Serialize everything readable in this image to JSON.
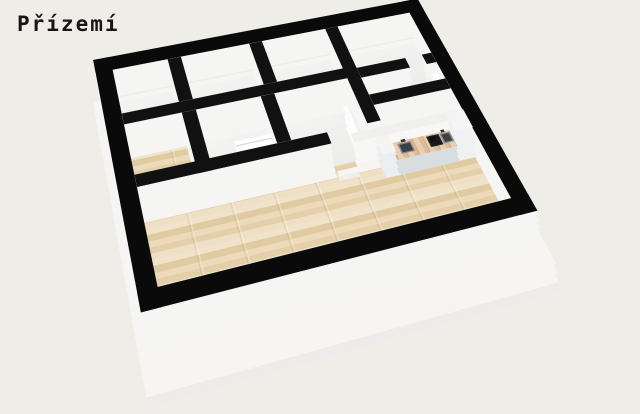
{
  "page": {
    "title": "Přízemí",
    "background": "#efede8",
    "title_color": "#161616"
  },
  "palette": {
    "wall_top": "#111111",
    "exterior_wall_top": "#0a0a0a",
    "wall_face": "#f5f5f4",
    "slab": "#f6f5f3",
    "slab_deep": "#edecea",
    "counter_front": "#d8dde0",
    "counter_top_wood": "#e6c39f",
    "halfwall_top": "#f1f0ee",
    "window_pane": "#ffffff",
    "wood_floor_base": "#e9d7b8"
  },
  "floorplan": {
    "plan_width": 460,
    "plan_height": 370,
    "matrix": [
      0.7873,
      -0.1336,
      0,
      0.0001967,
      0.0492,
      0.5056,
      0,
      -0.000566,
      -0.15,
      -1,
      1,
      0,
      98,
      92,
      0,
      1
    ],
    "wall_height": 32,
    "slab": {
      "u": -8,
      "v": 6,
      "w": 476,
      "h": 380,
      "depths": [
        -30,
        -22,
        -14,
        -6
      ]
    },
    "floors": [
      {
        "name": "room-top-left-floor",
        "u": 22,
        "v": 24,
        "w": 72,
        "h": 76,
        "surface": "plain"
      },
      {
        "name": "room-top-mid1-floor",
        "u": 112,
        "v": 24,
        "w": 93,
        "h": 76,
        "surface": "plain"
      },
      {
        "name": "room-top-mid2-floor",
        "u": 223,
        "v": 24,
        "w": 90,
        "h": 76,
        "surface": "plain"
      },
      {
        "name": "room-top-right-floor",
        "u": 331,
        "v": 24,
        "w": 107,
        "h": 80,
        "surface": "plain"
      },
      {
        "name": "room-mid-left-floor",
        "u": 112,
        "v": 118,
        "w": 84,
        "h": 78,
        "surface": "plain"
      },
      {
        "name": "room-mid-center-floor",
        "u": 214,
        "v": 118,
        "w": 99,
        "h": 78,
        "surface": "plain"
      },
      {
        "name": "room-right-a-floor",
        "u": 331,
        "v": 122,
        "w": 107,
        "h": 30,
        "surface": "plain"
      },
      {
        "name": "room-right-b-floor",
        "u": 331,
        "v": 170,
        "w": 107,
        "h": 26,
        "surface": "plain"
      },
      {
        "name": "hallway-wood-floor",
        "u": 22,
        "v": 118,
        "w": 72,
        "h": 78,
        "surface": "wood"
      },
      {
        "name": "doorway-threshold-floor",
        "u": 260,
        "v": 196,
        "w": 30,
        "h": 18,
        "surface": "wood"
      },
      {
        "name": "living-room-wood-floor",
        "u": 22,
        "v": 214,
        "w": 416,
        "h": 132,
        "surface": "wood"
      }
    ],
    "walls": [
      {
        "name": "exterior-wall-north",
        "u": 0,
        "v": 0,
        "w": 460,
        "h": 24,
        "height": 32,
        "exterior": true
      },
      {
        "name": "exterior-wall-south",
        "u": 0,
        "v": 346,
        "w": 460,
        "h": 24,
        "height": 32,
        "exterior": true
      },
      {
        "name": "exterior-wall-west",
        "u": 0,
        "v": 0,
        "w": 22,
        "h": 370,
        "height": 32,
        "exterior": true
      },
      {
        "name": "exterior-wall-east",
        "u": 438,
        "v": 0,
        "w": 22,
        "h": 370,
        "height": 32,
        "exterior": true
      },
      {
        "name": "wall-v1",
        "u": 94,
        "v": 24,
        "w": 18,
        "h": 76,
        "height": 32
      },
      {
        "name": "wall-v2",
        "u": 205,
        "v": 24,
        "w": 18,
        "h": 76,
        "height": 32
      },
      {
        "name": "wall-v3",
        "u": 313,
        "v": 24,
        "w": 18,
        "h": 172,
        "height": 32
      },
      {
        "name": "wall-h1",
        "u": 22,
        "v": 100,
        "w": 309,
        "h": 18,
        "height": 32
      },
      {
        "name": "wall-hall-right",
        "u": 94,
        "v": 118,
        "w": 18,
        "h": 96,
        "height": 32
      },
      {
        "name": "wall-mid-divider",
        "u": 196,
        "v": 118,
        "w": 18,
        "h": 78,
        "height": 32
      },
      {
        "name": "wall-living-north",
        "u": 22,
        "v": 196,
        "w": 238,
        "h": 18,
        "height": 32
      },
      {
        "name": "wall-h1b-west",
        "u": 331,
        "v": 104,
        "w": 69,
        "h": 18,
        "height": 32
      },
      {
        "name": "wall-h1b-east",
        "u": 424,
        "v": 104,
        "w": 14,
        "h": 18,
        "height": 32
      },
      {
        "name": "wall-h2b",
        "u": 331,
        "v": 152,
        "w": 107,
        "h": 18,
        "height": 32
      }
    ],
    "objects": [
      {
        "name": "kitchen-half-wall",
        "type": "stack",
        "u": 290,
        "v": 196,
        "w": 148,
        "h": 14,
        "height": 26,
        "top": "#f1f0ee",
        "face": "#f7f7f6"
      },
      {
        "name": "staircase",
        "type": "stack",
        "u": 150,
        "v": 150,
        "w": 46,
        "h": 46,
        "height": 14,
        "top": "treads",
        "face": "#fafaf9"
      },
      {
        "name": "door-leaf-hall",
        "type": "stack",
        "u": 294,
        "v": 152,
        "w": 6,
        "h": 44,
        "height": 26,
        "top": "#fdfdfd",
        "face": "#fdfdfc"
      },
      {
        "name": "door-leaf-room",
        "type": "stack",
        "u": 428,
        "v": 124,
        "w": 8,
        "h": 26,
        "height": 22,
        "top": "#fdfdfd",
        "face": "#fdfdfc"
      },
      {
        "name": "door-step",
        "type": "stack",
        "u": 262,
        "v": 214,
        "w": 26,
        "h": 8,
        "height": 6,
        "top": "#f6f6f5",
        "face": "#eeeeec"
      },
      {
        "name": "kitchen-tall-cabinet-left",
        "type": "stack",
        "u": 316,
        "v": 212,
        "w": 18,
        "h": 28,
        "height": 28,
        "top": "#f4f4f3",
        "face": "#eceff1"
      },
      {
        "name": "kitchen-counter",
        "type": "stack",
        "u": 334,
        "v": 214,
        "w": 80,
        "h": 26,
        "height": 20,
        "top": "wood2",
        "face": "#d8dde0"
      },
      {
        "name": "kitchen-tall-cabinet-right",
        "type": "stack",
        "u": 414,
        "v": 210,
        "w": 24,
        "h": 30,
        "height": 34,
        "top": "#f5f5f4",
        "face": "#eff1f2"
      },
      {
        "name": "window-pane-1",
        "type": "stack",
        "u": 441,
        "v": 282,
        "w": 16,
        "h": 17,
        "height": 28,
        "top": "#ffffff",
        "face": "#ffffff"
      },
      {
        "name": "window-pane-2",
        "type": "stack",
        "u": 441,
        "v": 304,
        "w": 16,
        "h": 17,
        "height": 28,
        "top": "#ffffff",
        "face": "#ffffff"
      },
      {
        "name": "window-pane-3",
        "type": "stack",
        "u": 441,
        "v": 326,
        "w": 16,
        "h": 17,
        "height": 28,
        "top": "#ffffff",
        "face": "#ffffff"
      },
      {
        "name": "kitchen-sink-left",
        "type": "flat",
        "cls": "sink",
        "u": 342,
        "v": 218,
        "w": 18,
        "h": 16,
        "z": 20.6
      },
      {
        "name": "kitchen-cooktop",
        "type": "flat",
        "cls": "cook",
        "u": 381,
        "v": 217,
        "w": 17,
        "h": 17,
        "z": 20.6
      },
      {
        "name": "kitchen-sink-right",
        "type": "flat",
        "cls": "sink",
        "u": 399,
        "v": 217,
        "w": 14,
        "h": 16,
        "z": 20.6
      },
      {
        "name": "kitchen-faucet-left",
        "type": "flat",
        "color": "#2e3133",
        "u": 348,
        "v": 214,
        "w": 6,
        "h": 4,
        "z": 21.2
      },
      {
        "name": "kitchen-faucet-right",
        "type": "flat",
        "color": "#2e3133",
        "u": 402,
        "v": 213,
        "w": 5,
        "h": 4,
        "z": 21.2
      },
      {
        "name": "pot-on-cooktop",
        "type": "flat",
        "cls": "pot",
        "u": 383,
        "v": 219,
        "w": 9,
        "h": 9,
        "z": 21.4
      }
    ]
  }
}
